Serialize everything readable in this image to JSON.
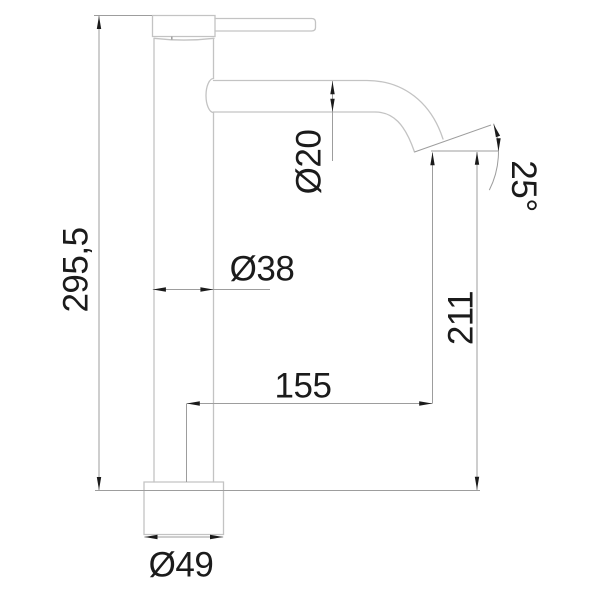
{
  "drawing": {
    "kind": "faucet-side-elevation",
    "colors": {
      "background": "#ffffff",
      "outline": "#c3c3c3",
      "dimension_lines": "#9d9d9d",
      "ink": "#1b1b1b"
    },
    "labels": {
      "overall_height": "295,5",
      "spout_diameter": "Ø20",
      "body_diameter": "Ø38",
      "spout_reach": "155",
      "outlet_height": "211",
      "outlet_angle": "25°",
      "base_diameter": "Ø49"
    }
  }
}
